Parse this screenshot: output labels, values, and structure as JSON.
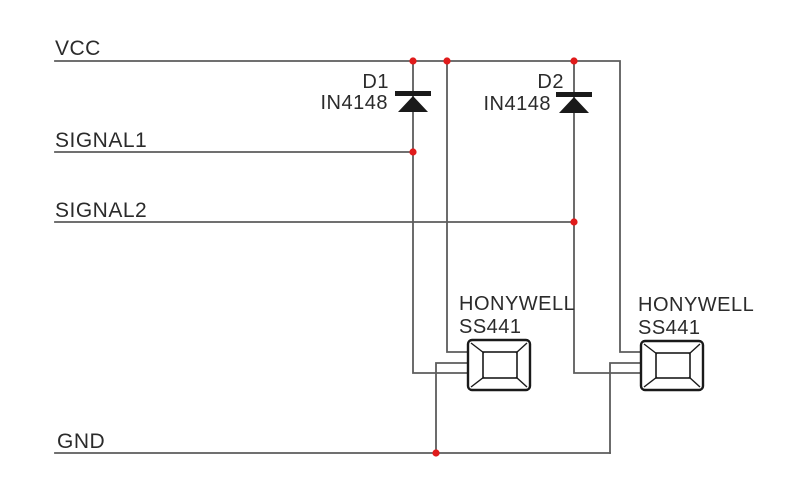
{
  "colors": {
    "wire": "#5c5c5c",
    "symbol": "#1a1a1a",
    "junction": "#e01b1b",
    "text": "#2b2b2b"
  },
  "rails": {
    "vcc": {
      "label": "VCC"
    },
    "signal1": {
      "label": "SIGNAL1"
    },
    "signal2": {
      "label": "SIGNAL2"
    },
    "gnd": {
      "label": "GND"
    }
  },
  "diodes": [
    {
      "designator": "D1",
      "part": "IN4148"
    },
    {
      "designator": "D2",
      "part": "IN4148"
    }
  ],
  "sensors": [
    {
      "brand": "HONYWELL",
      "model": "SS441"
    },
    {
      "brand": "HONYWELL",
      "model": "SS441"
    }
  ]
}
